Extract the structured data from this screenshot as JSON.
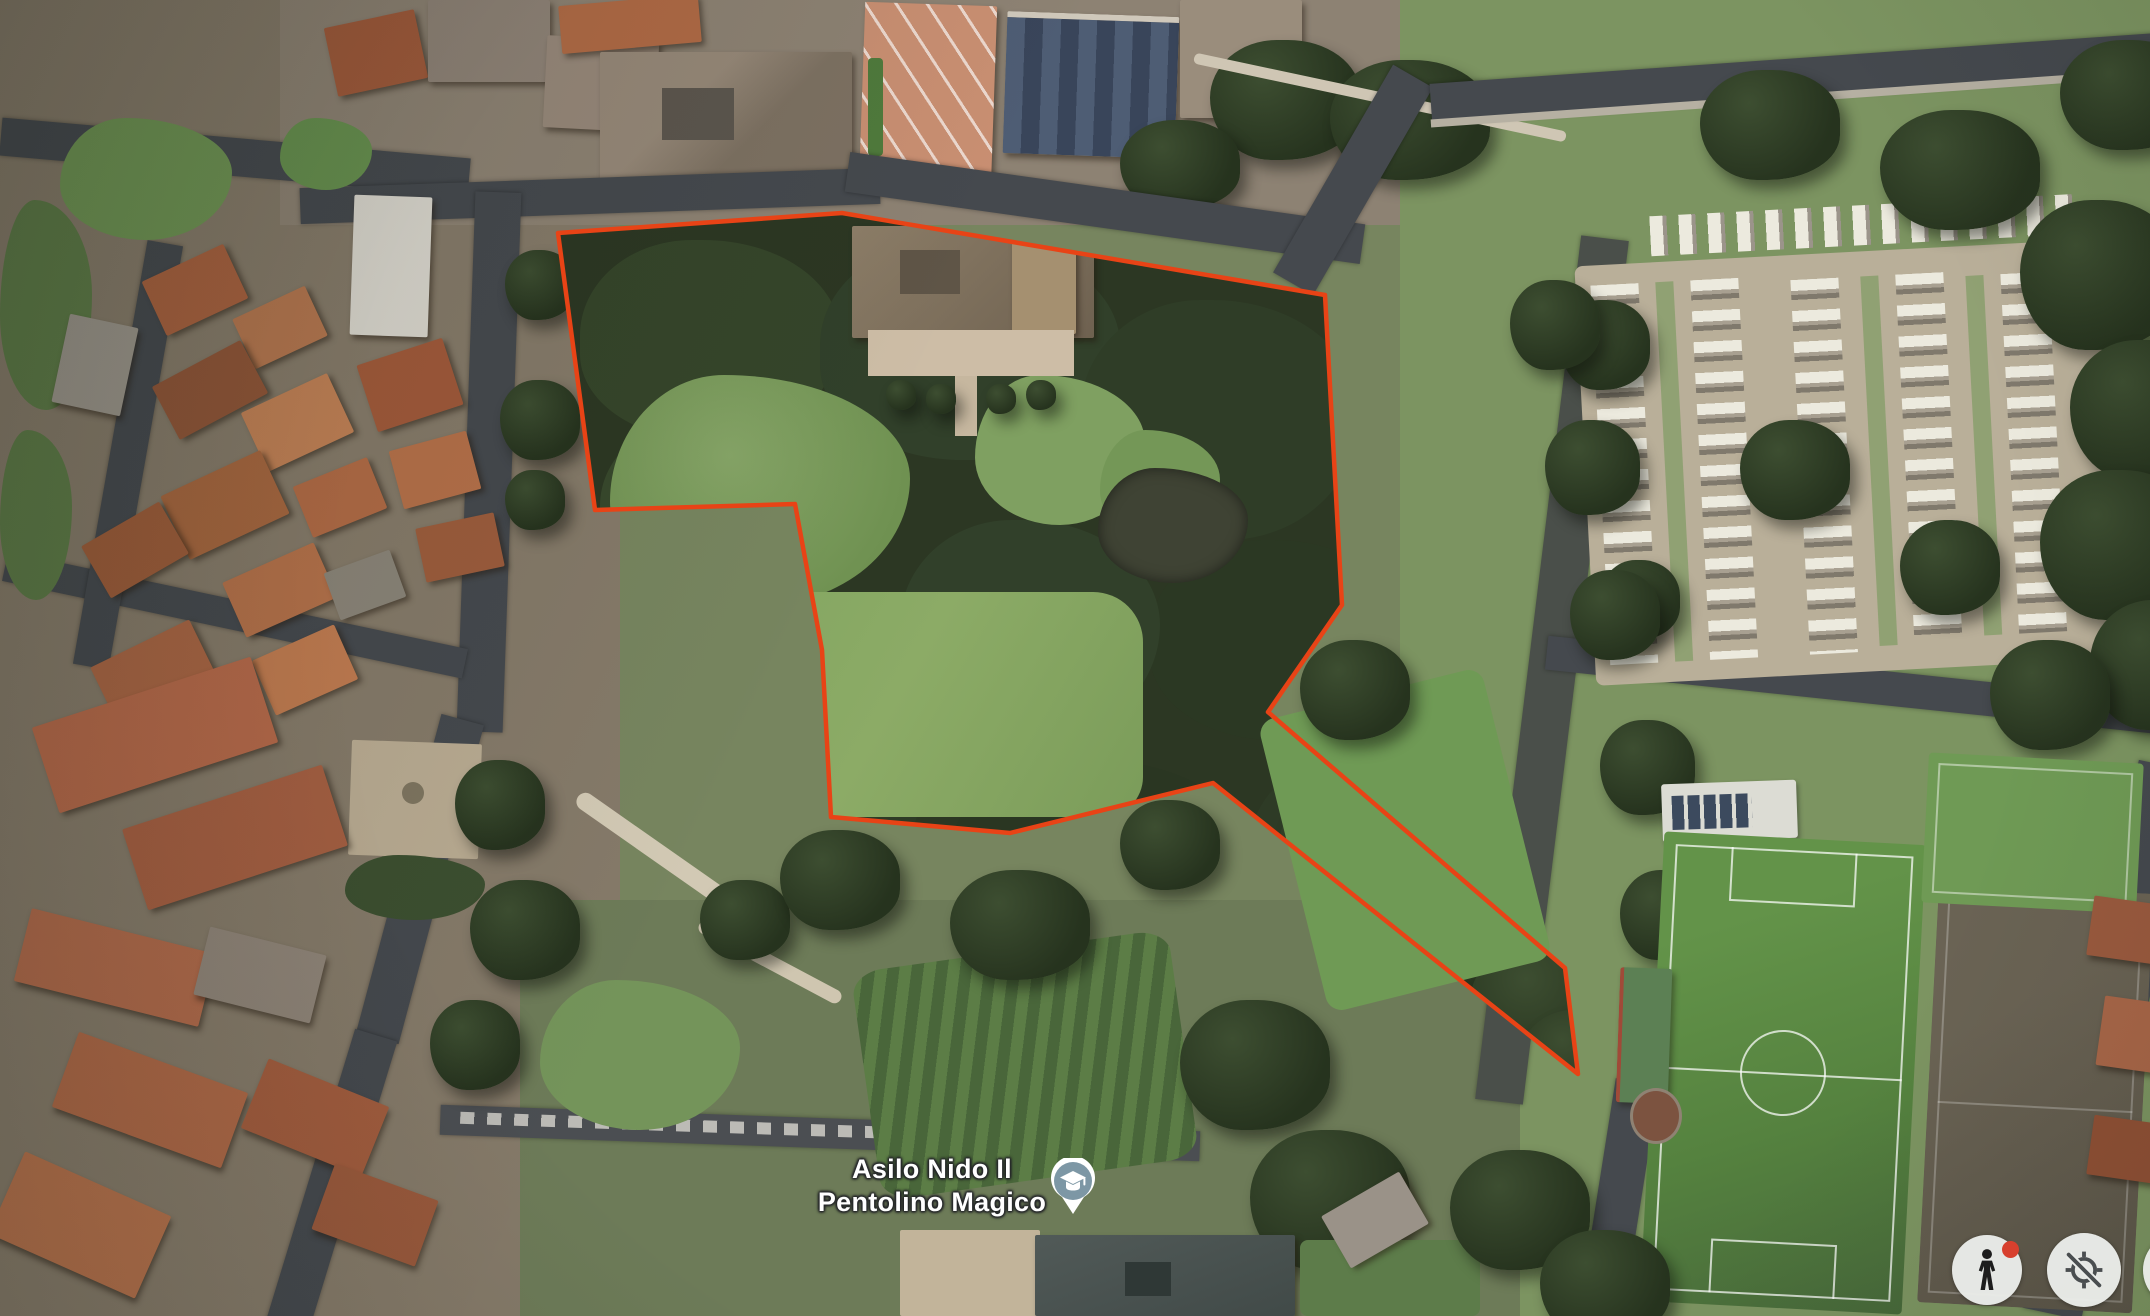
{
  "poi": {
    "label_line1": "Asilo Nido Il",
    "label_line2": "Pentolino Magico",
    "category": "school-marker",
    "marker_color": "#7d97a5"
  },
  "boundary": {
    "color": "#e84316",
    "points": "558,233 842,213 1325,295 1342,605 1268,712 1565,968 1578,1074 1213,783 1010,833 831,817 822,650 795,504 595,510"
  },
  "controls": {
    "pegman_badge_color": "#d7402e"
  }
}
